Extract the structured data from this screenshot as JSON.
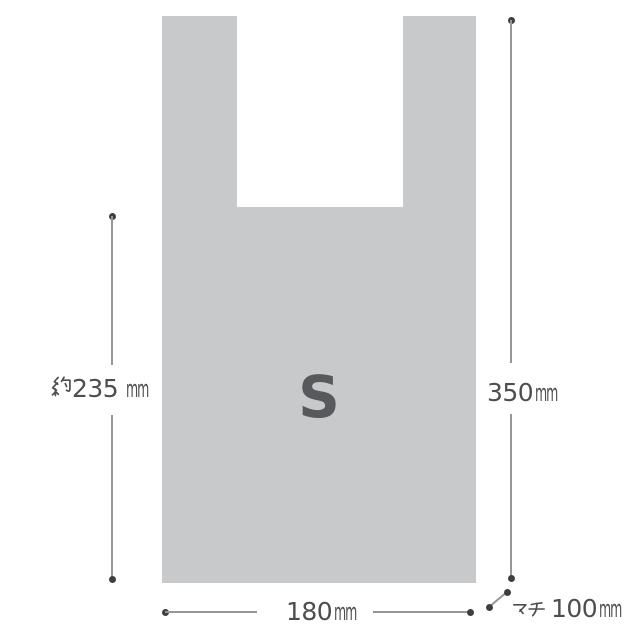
{
  "bag": {
    "size_label": "S",
    "shape": "t-shirt-style shopping bag, front view, two handles"
  },
  "dimensions": {
    "body_height": {
      "prefix": "約",
      "value": "235",
      "unit": "mm",
      "full_text": "約235mm",
      "side": "left"
    },
    "total_height": {
      "value": "350",
      "unit": "mm",
      "full_text": "350mm",
      "side": "right"
    },
    "width": {
      "value": "180",
      "unit": "mm",
      "full_text": "180mm",
      "side": "bottom"
    },
    "gusset": {
      "label": "マチ",
      "value": "100",
      "unit": "mm",
      "full_text": "マチ 100mm",
      "side": "bottom-right"
    }
  },
  "palette": {
    "bag_fill": "#c8c9cb",
    "line": "#979797",
    "dot": "#3f3f3f",
    "text": "#4d4e50",
    "letter": "#58595c",
    "background": "#ffffff"
  }
}
